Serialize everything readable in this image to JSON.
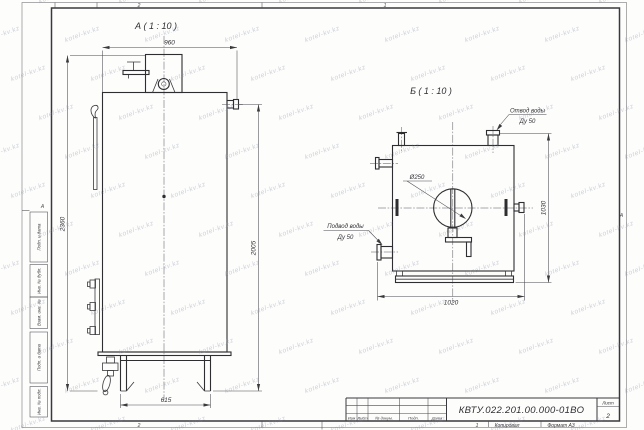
{
  "watermark": {
    "text": "kotel-kv.kz"
  },
  "sheet": {
    "zones": {
      "top_left": "2",
      "top_right": "1",
      "bottom_left": "2"
    },
    "fold_marks": {
      "left": "А",
      "right": "А"
    },
    "footer": {
      "copy_number": "1",
      "copied": "Копировал",
      "format": "Формат А3"
    }
  },
  "margin_column": {
    "cells": [
      "Подп. и дата",
      "Инв. № дубл.",
      "Взам. инв. №",
      "Подп. и дата",
      "Инв. № подл."
    ]
  },
  "title_block": {
    "doc_number": "КВТУ.022.201.00.000-01ВО",
    "sheet_label": "Лист",
    "sheet_value": "2",
    "revision_columns": [
      "Изм",
      "Лист",
      "№ докум.",
      "Подп.",
      "Дата"
    ]
  },
  "views": {
    "a": {
      "title": "А ( 1 : 10 )",
      "dim_width": "960",
      "dim_height_overall": "2360",
      "dim_height_body": "2005",
      "dim_base_width": "615"
    },
    "b": {
      "title": "Б ( 1 : 10 )",
      "dim_width": "1020",
      "dim_height": "1030",
      "dim_diameter": "Ø250",
      "callout_outlet": {
        "line1": "Отвод воды",
        "line2": "Ду 50"
      },
      "callout_inlet": {
        "line1": "Подвод воды",
        "line2": "Ду 50"
      }
    }
  }
}
